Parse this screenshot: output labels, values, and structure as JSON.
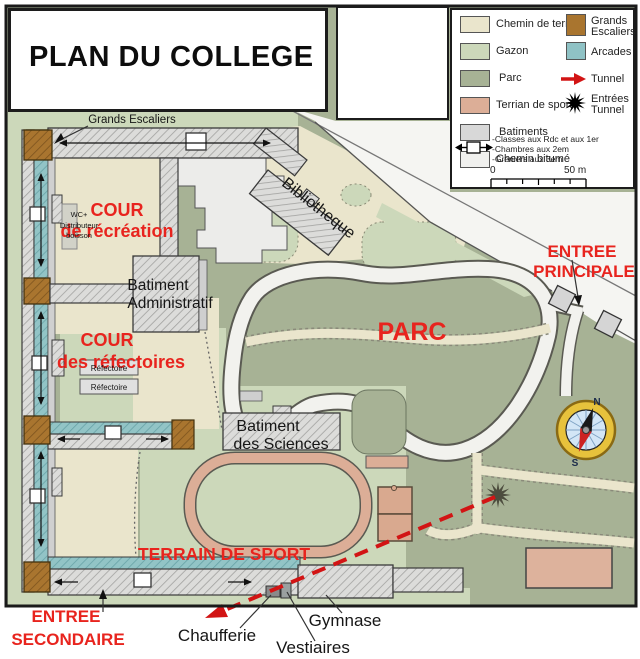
{
  "title": "PLAN DU COLLEGE",
  "colors": {
    "parc": "#a7b295",
    "gazon": "#ccd8ba",
    "chemin_terre": "#eae5cc",
    "sport": "#dcae97",
    "batiments": "#d8d8d8",
    "chemin_bitume": "#f0f0ee",
    "escaliers": "#a9752f",
    "arcades": "#8fc2c5",
    "label_red": "#e8241e",
    "tunnel_red": "#d21414"
  },
  "legend": {
    "areas": [
      {
        "label": "Chemin de terre",
        "color": "#eae5cc"
      },
      {
        "label": "Gazon",
        "color": "#ccd8ba"
      },
      {
        "label": "Parc",
        "color": "#a7b295"
      },
      {
        "label": "Terrian de sport",
        "color": "#dcae97"
      },
      {
        "label": "Batiments",
        "color": "#d8d8d8"
      },
      {
        "label": "Chemin bitumé",
        "color": "#f0f0ee"
      }
    ],
    "features": [
      {
        "label": "Grands Escaliers",
        "color": "#a9752f"
      },
      {
        "label": "Arcades",
        "color": "#8fc2c5"
      },
      {
        "label": "Tunnel"
      },
      {
        "label": "Entrées Tunnel"
      }
    ],
    "notes": [
      "-Classes aux Rdc et aux 1er",
      "-Chambres aux 2em",
      "-Greniers aux 3em"
    ],
    "scale_start": "0",
    "scale_end": "50 m"
  },
  "map": {
    "labels": {
      "grands_escaliers": "Grands Escaliers",
      "cour_recreation_1": "COUR",
      "cour_recreation_2": "de récréation",
      "wc_1": "WC+",
      "wc_2": "Distributeur",
      "wc_3": "boisson",
      "batiment_admin_1": "Batiment",
      "batiment_admin_2": "Administratif",
      "cour_refectoires_1": "COUR",
      "cour_refectoires_2": "des réfectoires",
      "refectoire_1": "Réfectoire",
      "refectoire_2": "Réfectoire",
      "bibliotheque": "Bibliotheque",
      "parc": "PARC",
      "entree_principale_1": "ENTREE",
      "entree_principale_2": "PRINCIPALE",
      "batiment_sciences_1": "Batiment",
      "batiment_sciences_2": "des Sciences",
      "terrain_sport": "TERRAIN DE SPORT",
      "entree_secondaire_1": "ENTREE",
      "entree_secondaire_2": "SECONDAIRE",
      "chaufferie": "Chaufferie",
      "vestiaires": "Vestiaires",
      "gymnase": "Gymnase",
      "compass_n": "N",
      "compass_s": "S"
    }
  }
}
